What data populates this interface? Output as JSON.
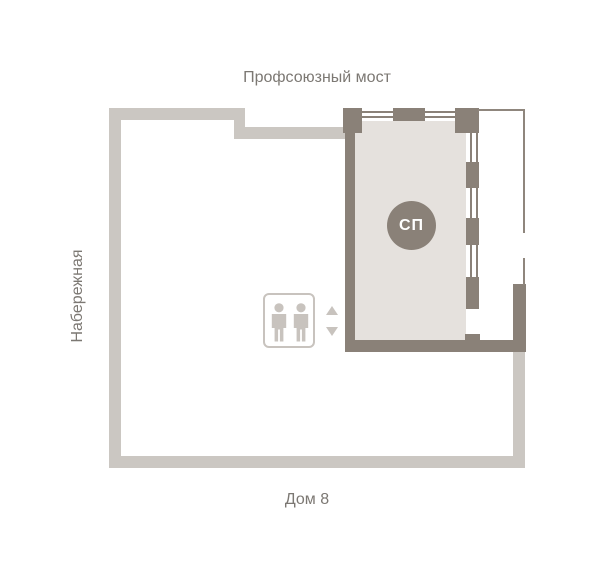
{
  "labels": {
    "street_top": "Профсоюзный мост",
    "street_left": "Набережная",
    "building_bottom": "Дом 8"
  },
  "unit": {
    "badge": "СП"
  },
  "colors": {
    "wall_dark": "#8a8178",
    "floor_beige": "#e5e1dd",
    "outline_light": "#cbc7c2",
    "icon_gray": "#c8c3be",
    "text_gray": "#7c7873",
    "badge_bg": "#8a8178",
    "badge_text": "#ffffff",
    "background": "#ffffff"
  },
  "icons": {
    "elevator": "elevator-persons-icon",
    "arrow_up": "arrow-up-icon",
    "arrow_down": "arrow-down-icon"
  }
}
